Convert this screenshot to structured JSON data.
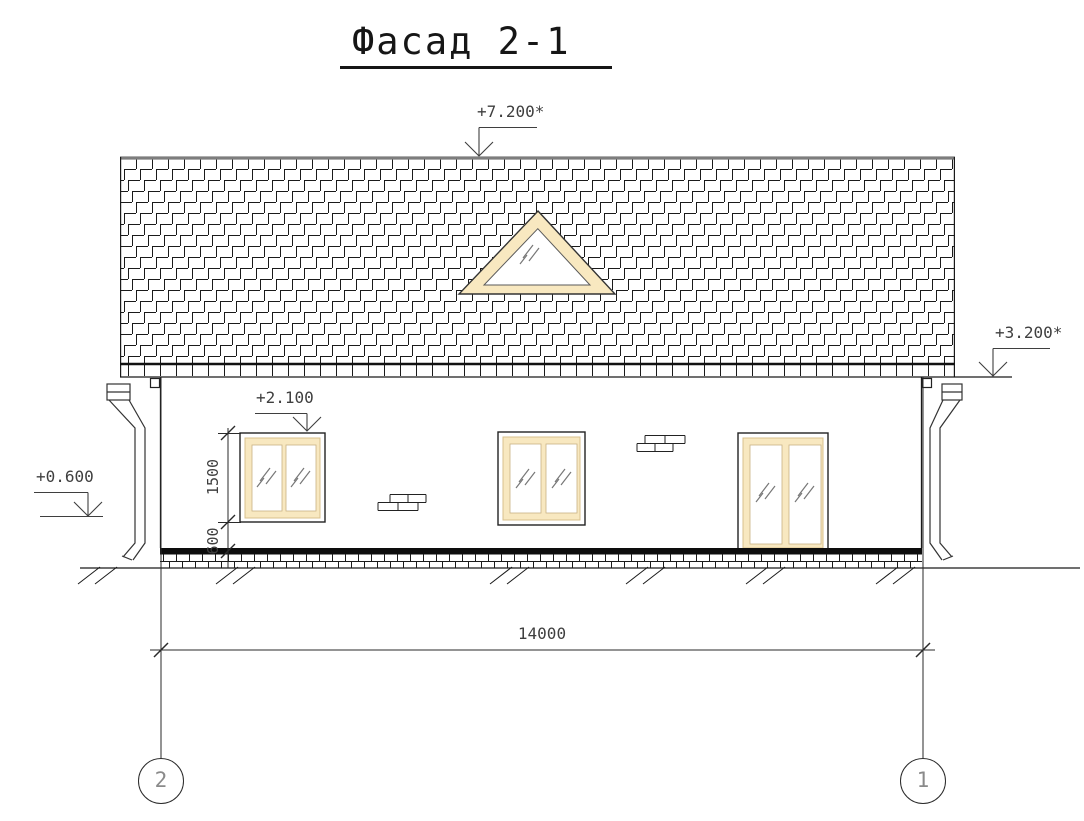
{
  "title": {
    "label": "Фасад 2-1"
  },
  "levels": {
    "ridge": "+7.200*",
    "eaves": "+3.200*",
    "window_head": "+2.100",
    "plinth": "+0.600"
  },
  "dimensions": {
    "overall_width": "14000",
    "window_height": "1500",
    "sill_height": "600"
  },
  "axes": {
    "left": "2",
    "right": "1"
  },
  "colors": {
    "frame_fill": "#F8E8C0",
    "frame_edge": "#D8C08C",
    "line": "#1a1a1a",
    "dim_text": "#3f3f3f",
    "axis_digit": "#8a8a8a"
  }
}
